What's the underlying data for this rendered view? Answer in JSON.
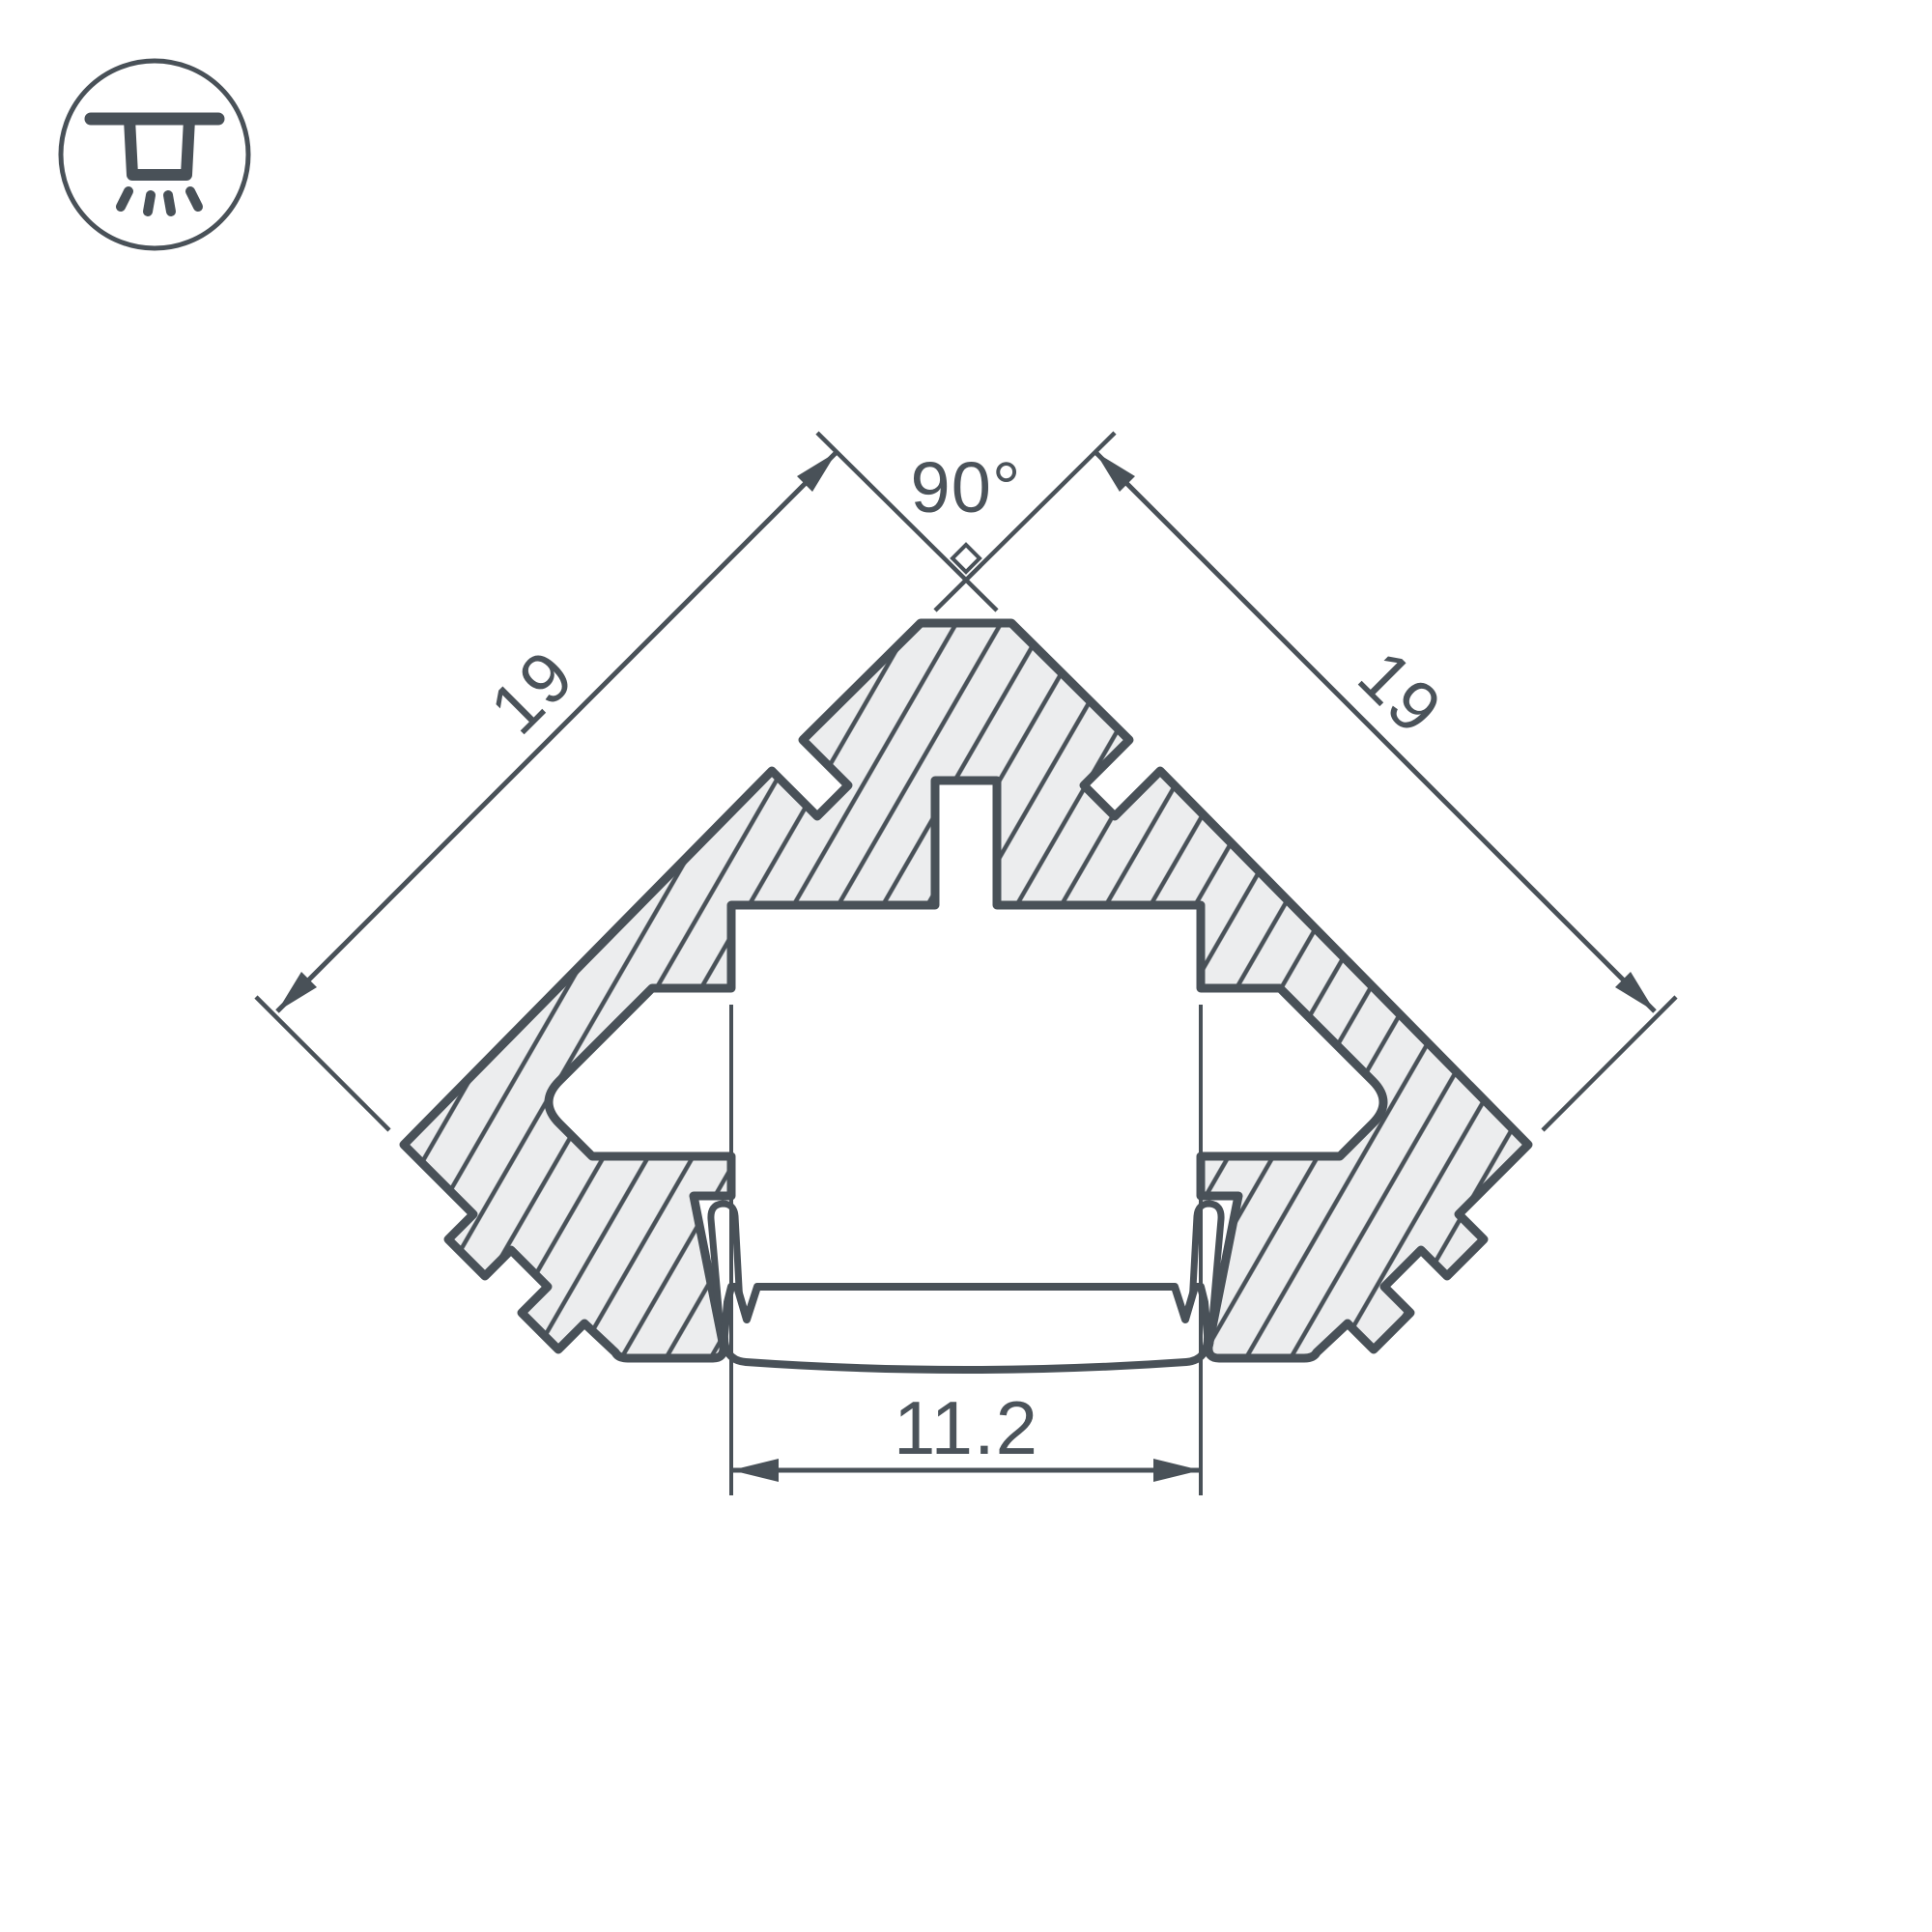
{
  "drawing": {
    "title": "Corner LED profile cross-section drawing",
    "labels": {
      "angle_top": "90°",
      "side_left": "19",
      "side_right": "19",
      "width_bottom": "11.2"
    },
    "colors": {
      "line": "#495158",
      "body_fill": "#ecedee",
      "background": "#ffffff",
      "text": "#4b535a"
    },
    "icon": {
      "name": "recessed-ceiling-light-icon",
      "meaning": "mounting type pictogram"
    }
  }
}
